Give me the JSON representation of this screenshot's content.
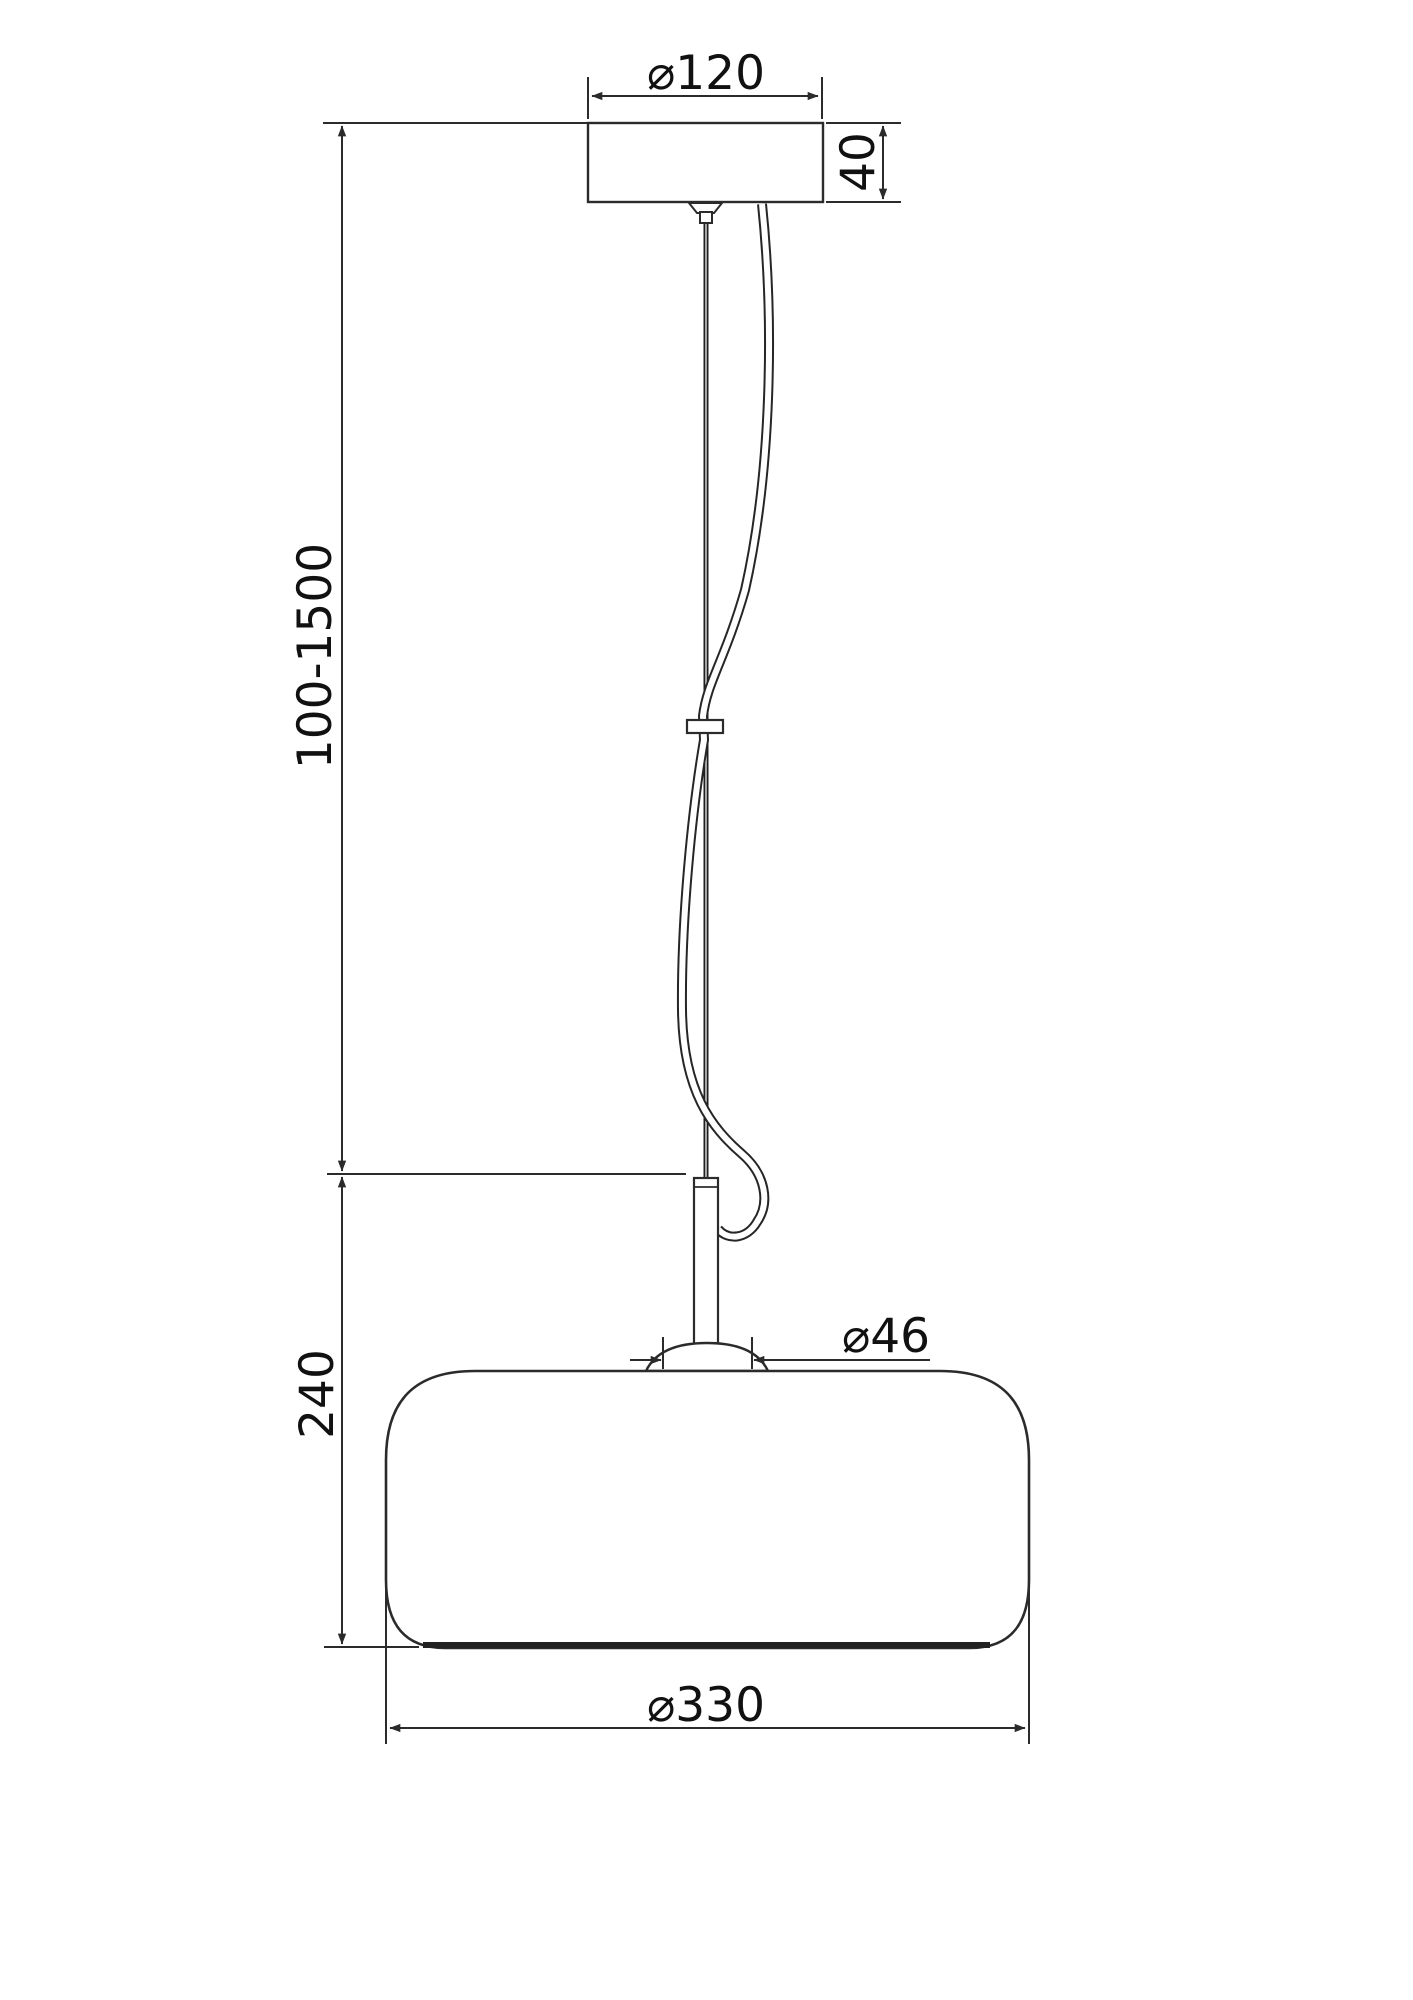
{
  "drawing": {
    "type": "technical-dimension-drawing",
    "subject": "pendant-lamp",
    "background": "#ffffff",
    "line_color": "#2b2b2b",
    "text_color": "#111111",
    "dimensions": {
      "canopy_diameter": {
        "label": "⌀120"
      },
      "canopy_height": {
        "label": "40"
      },
      "suspension_length": {
        "label": "100-1500"
      },
      "shade_height": {
        "label": "240"
      },
      "socket_diameter": {
        "label": "⌀46"
      },
      "shade_diameter": {
        "label": "⌀330"
      }
    }
  }
}
